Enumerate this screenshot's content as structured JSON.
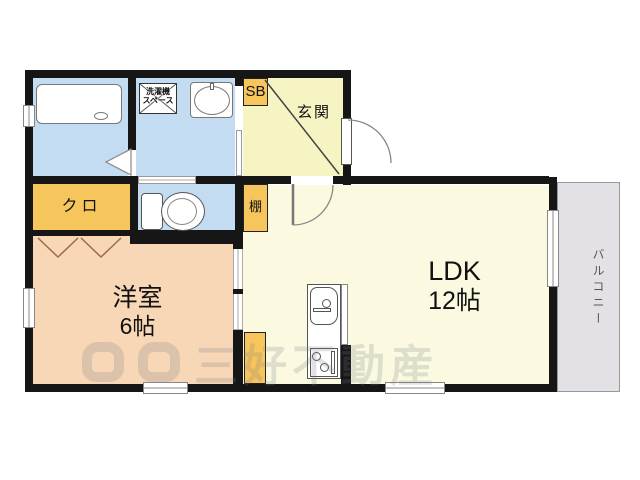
{
  "rooms": {
    "western_room": {
      "name": "洋室",
      "size": "6帖"
    },
    "ldk": {
      "name": "LDK",
      "size": "12帖"
    },
    "entrance": {
      "name": "玄関"
    },
    "balcony": {
      "name": "バルコニー"
    },
    "closet": {
      "name": "クロ"
    },
    "shelf": {
      "name": "棚"
    },
    "shoe_box": {
      "name": "SB"
    },
    "laundry_space": {
      "line1": "洗濯機",
      "line2": "スペース"
    }
  },
  "watermark": {
    "text": "三好不動産"
  },
  "colors": {
    "wet_area_blue": "#c3dcf2",
    "storage_orange": "#f6c55c",
    "entrance_yellow": "#f7f4c4",
    "ldk_yellow": "#fbfae0",
    "room_peach": "#f7d7b5",
    "balcony_gray": "#e4e1e6",
    "wall_black": "#161616"
  }
}
